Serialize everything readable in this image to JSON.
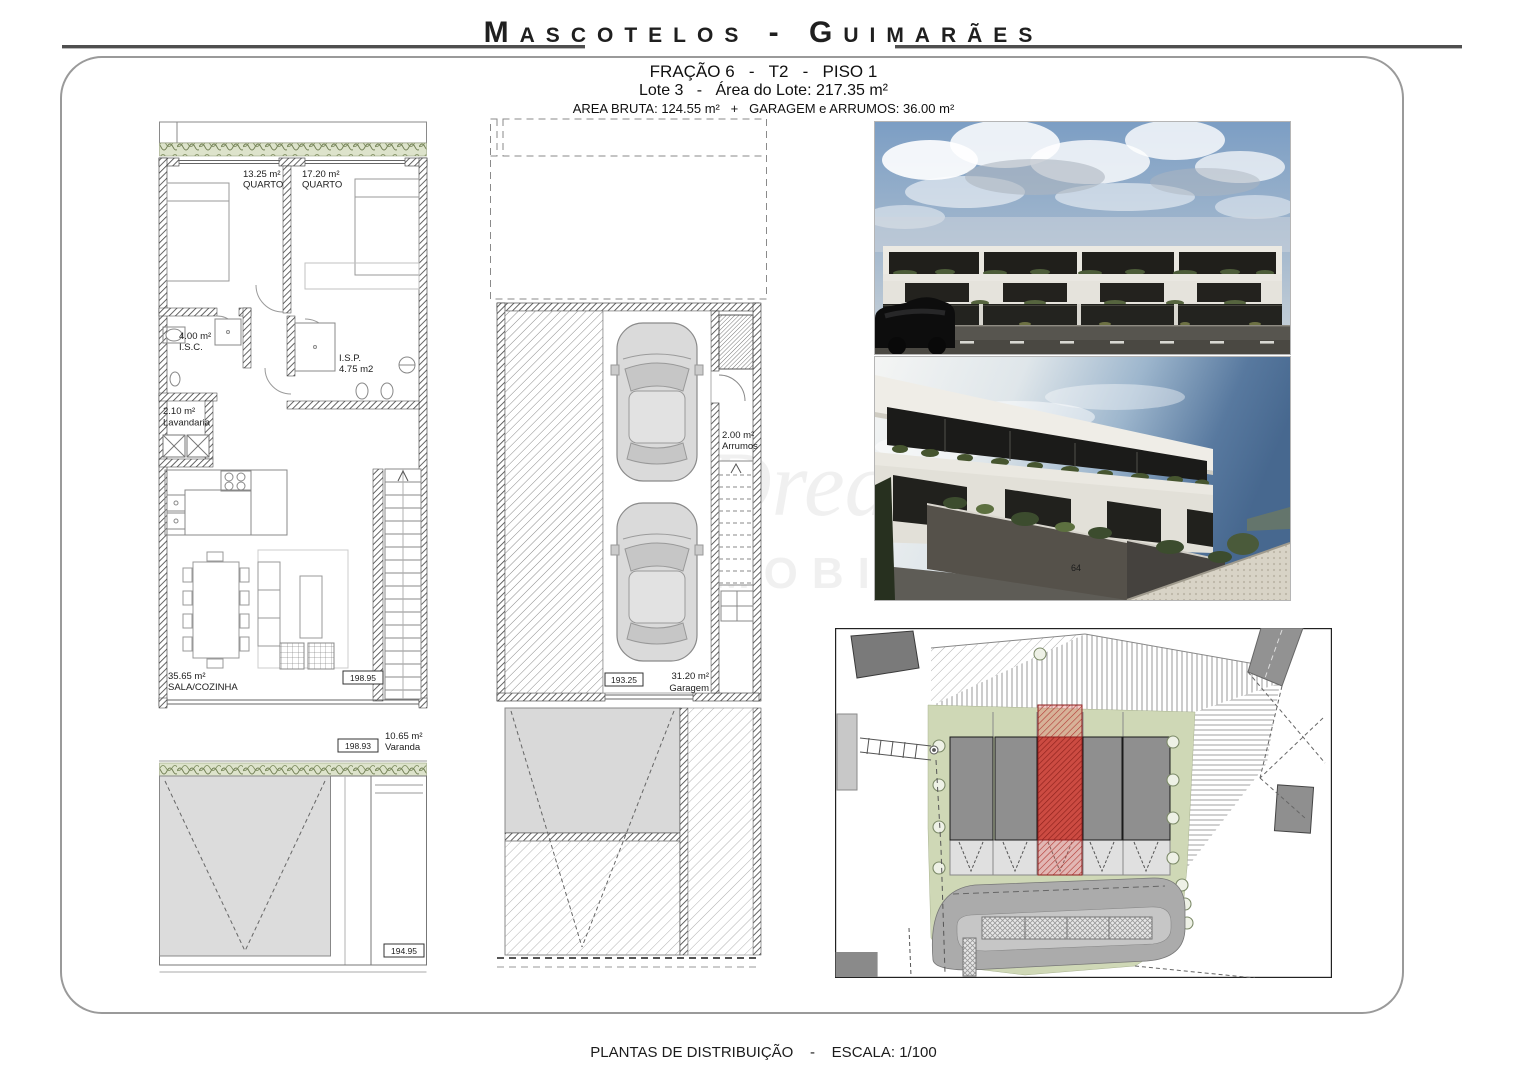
{
  "header": {
    "title": "Mascotelos - Guimarães",
    "fraction_line": "FRAÇÃO 6   -   T2   -   PISO 1",
    "lot_line": "Lote 3   -   Área do Lote: 217.35 m²",
    "area_line": "AREA BRUTA: 124.55 m²   +   GARAGEM e ARRUMOS: 36.00 m²"
  },
  "apartment_plan": {
    "quarto1": {
      "area": "13.25 m²",
      "name": "QUARTO"
    },
    "quarto2": {
      "area": "17.20 m²",
      "name": "QUARTO"
    },
    "isc": {
      "area": "4.00 m²",
      "name": "I.S.C."
    },
    "isp": {
      "name": "I.S.P.",
      "area": "4.75 m2"
    },
    "lavandaria": {
      "area": "2.10 m²",
      "name": "Lavandaria"
    },
    "sala": {
      "area": "35.65 m²",
      "name": "SALA/COZINHA"
    },
    "varanda": {
      "area": "10.65 m²",
      "name": "Varanda"
    },
    "level_sala": "198.95",
    "level_varanda": "198.93",
    "level_exterior": "194.95"
  },
  "garage_plan": {
    "arrumos": {
      "area": "2.00 m²",
      "name": "Arrumos"
    },
    "garagem": {
      "area": "31.20 m²",
      "name": "Garagem"
    },
    "level_garagem": "193.25"
  },
  "photos": {
    "house_number": "64"
  },
  "watermark": {
    "brand": "Dream",
    "word": "MOBILIÁRIA"
  },
  "footer": {
    "text": "PLANTAS DE DISTRIBUIÇÃO    -    ESCALA: 1/100"
  }
}
